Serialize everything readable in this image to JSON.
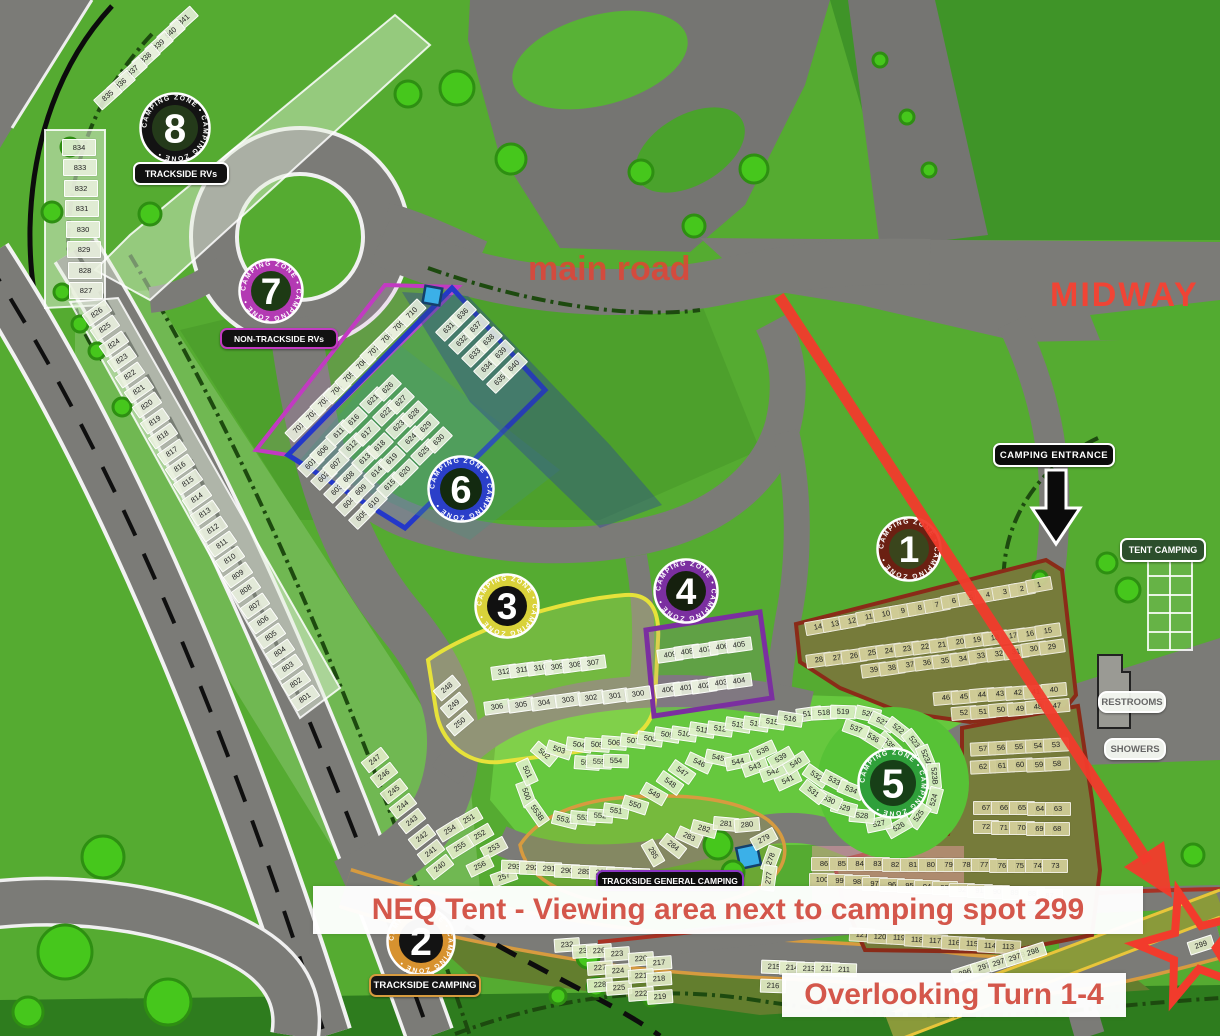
{
  "annotations": {
    "main_road": "main road",
    "midway": "MIDWAY",
    "banner_top": "NEQ Tent - Viewing area next to camping spot 299",
    "banner_bottom": "Overlooking Turn 1-4"
  },
  "labels": {
    "trackside_rvs": "TRACKSIDE RVs",
    "non_trackside_rvs": "NON-TRACKSIDE RVs",
    "camping_entrance": "CAMPING ENTRANCE",
    "tent_camping": "TENT CAMPING",
    "restrooms": "RESTROOMS",
    "showers": "SHOWERS",
    "trackside_general_camping": "TRACKSIDE GENERAL CAMPING",
    "trackside_camping": "TRACKSIDE CAMPING"
  },
  "colors": {
    "annotation_red": "#e8493c",
    "arrow_red": "#f23b2c",
    "road_gray": "#7b7b77",
    "grass_green": "#55ab31"
  },
  "ring_text": "CAMPING ZONE • CAMPING ZONE •",
  "badges": [
    {
      "n": "8",
      "x": 175,
      "y": 128,
      "d": 72,
      "ring": "#131313",
      "center": "#243a1a"
    },
    {
      "n": "7",
      "x": 271,
      "y": 291,
      "d": 66,
      "ring": "#b33ab3",
      "center": "#1d3a14"
    },
    {
      "n": "6",
      "x": 461,
      "y": 489,
      "d": 68,
      "ring": "#2b3fc9",
      "center": "#132a10"
    },
    {
      "n": "3",
      "x": 507,
      "y": 606,
      "d": 66,
      "ring": "#d9d23a",
      "center": "#111111"
    },
    {
      "n": "4",
      "x": 686,
      "y": 591,
      "d": 66,
      "ring": "#7b2fa0",
      "center": "#15200e"
    },
    {
      "n": "1",
      "x": 909,
      "y": 549,
      "d": 66,
      "ring": "#6b2012",
      "center": "#3a451c"
    },
    {
      "n": "5",
      "x": 893,
      "y": 783,
      "d": 72,
      "ring": "#2fa03a",
      "center": "#173f17"
    },
    {
      "n": "2",
      "x": 421,
      "y": 941,
      "d": 70,
      "ring": "#d7922f",
      "center": "#131313"
    }
  ],
  "clusters": [
    {
      "name": "zone8-strip",
      "style": "pale",
      "rot": -42,
      "cw": 26,
      "row": {
        "x": 183,
        "y": 19,
        "dx": -12.7,
        "dy": 12.7,
        "labels": [
          "841",
          "840",
          "839",
          "838",
          "837",
          "836",
          "835"
        ]
      }
    },
    {
      "name": "zone8-col",
      "style": "pale",
      "rot": 0,
      "cw": 32,
      "ch": 15,
      "row": {
        "x": 78,
        "y": 146,
        "dx": 1,
        "dy": 20.5,
        "labels": [
          "834",
          "833",
          "832",
          "831",
          "830",
          "829",
          "828",
          "827"
        ]
      }
    },
    {
      "name": "zone8-diag",
      "style": "pale",
      "rot": -35,
      "cw": 26,
      "row": {
        "x": 96,
        "y": 312,
        "dx": 8.3,
        "dy": 15.4,
        "labels": [
          "826",
          "825",
          "824",
          "823",
          "822",
          "821",
          "820",
          "819",
          "818",
          "817",
          "816",
          "815",
          "814",
          "813",
          "812",
          "811",
          "810",
          "809",
          "808",
          "807",
          "806",
          "805",
          "804",
          "803",
          "802",
          "801"
        ]
      }
    },
    {
      "name": "zone7-row",
      "style": "pale",
      "rot": -45,
      "cw": 26,
      "row": {
        "x": 298,
        "y": 427,
        "dx": 12.5,
        "dy": -12.8,
        "labels": [
          "701",
          "702",
          "703",
          "704",
          "705",
          "706",
          "707",
          "708",
          "709",
          "710"
        ]
      }
    },
    {
      "name": "zone6-grid",
      "style": "pale",
      "rot": -45,
      "grid": {
        "start": 601,
        "perCol": 5,
        "rowStep": [
          12.8,
          13
        ],
        "cols": [
          [
            310,
            463
          ],
          [
            322,
            450
          ],
          [
            338,
            432
          ],
          [
            353,
            419
          ],
          [
            372,
            399
          ],
          [
            387,
            387
          ],
          [
            448,
            327
          ],
          [
            462,
            313
          ]
        ]
      }
    },
    {
      "name": "zone3-r1",
      "style": "pale",
      "rot": -8,
      "row": {
        "x": 503,
        "y": 671,
        "dx": 17.8,
        "dy": -1.8,
        "labels": [
          "312",
          "311",
          "310",
          "309",
          "308",
          "307"
        ]
      }
    },
    {
      "name": "zone3-r2",
      "style": "pale",
      "rot": -8,
      "row": {
        "x": 496,
        "y": 706,
        "dx": 23.5,
        "dy": -2.2,
        "labels": [
          "306",
          "305",
          "304",
          "303",
          "302",
          "301",
          "300"
        ]
      }
    },
    {
      "name": "zone3-side",
      "style": "pale",
      "cells": [
        [
          "248",
          446,
          687,
          -40
        ],
        [
          "249",
          453,
          704,
          -40
        ],
        [
          "250",
          459,
          722,
          -40
        ]
      ]
    },
    {
      "name": "zone4-r1",
      "style": "pale",
      "rot": -8,
      "row": {
        "x": 669,
        "y": 654,
        "dx": 17.3,
        "dy": -2.6,
        "labels": [
          "409",
          "408",
          "407",
          "406",
          "405"
        ]
      }
    },
    {
      "name": "zone4-r2",
      "style": "pale",
      "rot": -8,
      "row": {
        "x": 667,
        "y": 689,
        "dx": 17.8,
        "dy": -2.2,
        "labels": [
          "400",
          "401",
          "402",
          "403",
          "404"
        ]
      }
    },
    {
      "name": "zone1-r1",
      "style": "olive",
      "rot": -10,
      "row": {
        "x": 817,
        "y": 626,
        "dx": 17.0,
        "dy": -3.2,
        "labels": [
          "14",
          "13",
          "12",
          "11",
          "10",
          "9",
          "8",
          "7",
          "6",
          "5",
          "4",
          "3",
          "2",
          "1"
        ]
      }
    },
    {
      "name": "zone1-r2",
      "style": "olive",
      "rot": -8,
      "row": {
        "x": 818,
        "y": 659,
        "dx": 17.6,
        "dy": -2.2,
        "labels": [
          "28",
          "27",
          "26",
          "25",
          "24",
          "23",
          "22",
          "21",
          "20",
          "19",
          "18",
          "17",
          "16",
          "15"
        ]
      }
    },
    {
      "name": "zone1-r3",
      "style": "olive",
      "rot": -8,
      "row": {
        "x": 873,
        "y": 669,
        "dx": 17.8,
        "dy": -2.3,
        "labels": [
          "39",
          "38",
          "37",
          "36",
          "35",
          "34",
          "33",
          "32",
          "31",
          "30",
          "29"
        ]
      }
    },
    {
      "name": "zone1-r4",
      "style": "olive",
      "rot": -5,
      "row": {
        "x": 945,
        "y": 697,
        "dx": 18,
        "dy": -1.3,
        "labels": [
          "46",
          "45",
          "44",
          "43",
          "42",
          "41",
          "40"
        ]
      }
    },
    {
      "name": "zone1-r5",
      "style": "olive",
      "rot": -5,
      "row": {
        "x": 963,
        "y": 712,
        "dx": 18.5,
        "dy": -1.5,
        "labels": [
          "52",
          "51",
          "50",
          "49",
          "48",
          "47"
        ]
      }
    },
    {
      "name": "zone1-r6",
      "style": "olive",
      "rot": -3,
      "row": {
        "x": 982,
        "y": 748,
        "dx": 18.2,
        "dy": -1,
        "labels": [
          "57",
          "56",
          "55",
          "54",
          "53"
        ]
      }
    },
    {
      "name": "zone1-r7",
      "style": "olive",
      "rot": -3,
      "row": {
        "x": 982,
        "y": 766,
        "dx": 18.5,
        "dy": -0.8,
        "labels": [
          "62",
          "61",
          "60",
          "59",
          "58"
        ]
      }
    },
    {
      "name": "zone1-r8",
      "style": "olive",
      "rot": 0,
      "row": {
        "x": 985,
        "y": 807,
        "dx": 18,
        "dy": 0.2,
        "labels": [
          "67",
          "66",
          "65",
          "64",
          "63"
        ]
      }
    },
    {
      "name": "zone1-r9",
      "style": "olive",
      "rot": 0,
      "row": {
        "x": 985,
        "y": 826,
        "dx": 17.8,
        "dy": 0.5,
        "labels": [
          "72",
          "71",
          "70",
          "69",
          "68"
        ]
      }
    },
    {
      "name": "zone1-r10",
      "style": "olive",
      "rot": 0,
      "row": {
        "x": 823,
        "y": 863,
        "dx": 17.8,
        "dy": 0.15,
        "labels": [
          "86",
          "85",
          "84",
          "83",
          "82",
          "81",
          "80",
          "79",
          "78",
          "77",
          "76",
          "75",
          "74",
          "73"
        ]
      }
    },
    {
      "name": "zone1-r11",
      "style": "olive",
      "rot": 0,
      "row": {
        "x": 821,
        "y": 879,
        "dx": 17.5,
        "dy": 1.2,
        "labels": [
          "100",
          "99",
          "98",
          "97",
          "96",
          "95",
          "94",
          "93",
          "92",
          "91",
          "90",
          "89",
          "88",
          "87"
        ]
      }
    },
    {
      "name": "zone1-r12",
      "style": "olive",
      "rot": 3,
      "row": {
        "x": 861,
        "y": 934,
        "dx": 18.3,
        "dy": 1.5,
        "labels": [
          "121",
          "120",
          "119",
          "118",
          "117",
          "116",
          "115",
          "114",
          "113"
        ]
      }
    },
    {
      "name": "row-215",
      "style": "pale2",
      "rot": 2,
      "row": {
        "x": 773,
        "y": 966,
        "dx": 17.5,
        "dy": 0.8,
        "labels": [
          "215",
          "214",
          "213",
          "212",
          "211"
        ]
      }
    },
    {
      "name": "cell-216",
      "style": "pale2",
      "cells": [
        [
          "216",
          772,
          985,
          2
        ]
      ]
    },
    {
      "name": "zone5-ring",
      "style": "bright",
      "cells": [
        [
          "517",
          808,
          713,
          -8
        ],
        [
          "518",
          823,
          712,
          -3
        ],
        [
          "519",
          842,
          711,
          2
        ],
        [
          "520",
          867,
          713,
          12
        ],
        [
          "521",
          881,
          721,
          25
        ],
        [
          "522",
          897,
          728,
          38
        ],
        [
          "523",
          913,
          741,
          52
        ],
        [
          "523A",
          925,
          757,
          68
        ],
        [
          "523B",
          933,
          775,
          85
        ],
        [
          "524",
          933,
          799,
          -75
        ],
        [
          "525",
          918,
          815,
          -55
        ],
        [
          "526",
          898,
          826,
          -30
        ],
        [
          "527",
          878,
          823,
          -12
        ],
        [
          "528",
          861,
          815,
          5
        ],
        [
          "529",
          843,
          807,
          15
        ],
        [
          "530",
          828,
          799,
          25
        ],
        [
          "531",
          812,
          791,
          38
        ],
        [
          "532",
          815,
          775,
          35
        ],
        [
          "533",
          833,
          780,
          28
        ],
        [
          "534",
          850,
          789,
          22
        ],
        [
          "535",
          888,
          743,
          45
        ],
        [
          "536",
          872,
          737,
          32
        ],
        [
          "537",
          855,
          728,
          20
        ]
      ]
    },
    {
      "name": "serpentine-500s",
      "style": "bright",
      "cells": [
        [
          "500",
          525,
          793,
          70
        ],
        [
          "501",
          526,
          771,
          65
        ],
        [
          "502",
          543,
          753,
          40
        ],
        [
          "503",
          558,
          749,
          18
        ],
        [
          "504",
          578,
          744,
          8
        ],
        [
          "505",
          596,
          744,
          4
        ],
        [
          "506",
          613,
          742,
          4
        ],
        [
          "507",
          632,
          740,
          7
        ],
        [
          "508",
          649,
          738,
          8
        ],
        [
          "509",
          666,
          734,
          9
        ],
        [
          "510",
          683,
          733,
          8
        ],
        [
          "511",
          701,
          729,
          9
        ],
        [
          "512",
          719,
          728,
          8
        ],
        [
          "513",
          737,
          724,
          9
        ],
        [
          "514",
          755,
          723,
          8
        ],
        [
          "515",
          771,
          721,
          8
        ],
        [
          "516",
          789,
          718,
          9
        ],
        [
          "556",
          586,
          762,
          4
        ],
        [
          "555",
          598,
          761,
          3
        ],
        [
          "554",
          615,
          760,
          2
        ],
        [
          "553B",
          536,
          812,
          55
        ],
        [
          "553A",
          564,
          819,
          14
        ],
        [
          "553",
          582,
          817,
          5
        ],
        [
          "552",
          599,
          815,
          3
        ],
        [
          "551",
          615,
          810,
          8
        ],
        [
          "550",
          634,
          804,
          18
        ],
        [
          "549",
          653,
          793,
          30
        ],
        [
          "548",
          669,
          782,
          35
        ],
        [
          "547",
          681,
          771,
          35
        ],
        [
          "546",
          698,
          762,
          25
        ],
        [
          "545",
          717,
          757,
          12
        ],
        [
          "544",
          737,
          761,
          -12
        ],
        [
          "543",
          754,
          766,
          -20
        ],
        [
          "542",
          772,
          771,
          -20
        ],
        [
          "541",
          787,
          779,
          -25
        ],
        [
          "540",
          795,
          762,
          -33
        ],
        [
          "539",
          780,
          757,
          -30
        ],
        [
          "538",
          762,
          750,
          -25
        ]
      ]
    },
    {
      "name": "strip-240s",
      "style": "pale2",
      "rot": -38,
      "row": {
        "x": 374,
        "y": 759,
        "dx": 9.3,
        "dy": 15.3,
        "labels": [
          "247",
          "246",
          "245",
          "244",
          "243",
          "242",
          "241",
          "240"
        ]
      }
    },
    {
      "name": "scatter-250s",
      "style": "pale2",
      "cells": [
        [
          "251",
          468,
          818,
          -30
        ],
        [
          "254",
          449,
          829,
          -32
        ],
        [
          "252",
          479,
          834,
          -30
        ],
        [
          "255",
          459,
          846,
          -32
        ],
        [
          "253",
          493,
          847,
          -28
        ],
        [
          "256",
          479,
          865,
          -26
        ],
        [
          "257",
          503,
          876,
          -20
        ]
      ]
    },
    {
      "name": "loop-280s",
      "style": "pale2",
      "cells": [
        [
          "285",
          652,
          852,
          60
        ],
        [
          "284",
          672,
          845,
          38
        ],
        [
          "283",
          688,
          836,
          25
        ],
        [
          "282",
          703,
          828,
          15
        ],
        [
          "281",
          725,
          823,
          5
        ],
        [
          "280",
          746,
          824,
          -5
        ],
        [
          "279",
          763,
          838,
          -28
        ],
        [
          "278",
          770,
          858,
          -70
        ],
        [
          "277",
          768,
          877,
          -82
        ]
      ]
    },
    {
      "name": "row-286-293",
      "style": "pale2",
      "rot": 2,
      "row": {
        "x": 513,
        "y": 866,
        "dx": 17.5,
        "dy": 1.2,
        "labels": [
          "293",
          "292",
          "291",
          "290",
          "289",
          "288",
          "287",
          "286"
        ]
      }
    },
    {
      "name": "blocks-220s",
      "style": "pale2",
      "cells": [
        [
          "232",
          566,
          944,
          -4
        ],
        [
          "230",
          584,
          950,
          -4
        ],
        [
          "226",
          598,
          950,
          -4
        ],
        [
          "223",
          616,
          953,
          -4
        ],
        [
          "227",
          599,
          967,
          -4
        ],
        [
          "224",
          617,
          970,
          -4
        ],
        [
          "228",
          599,
          984,
          -4
        ],
        [
          "225",
          618,
          987,
          -4
        ],
        [
          "220",
          640,
          958,
          -4
        ],
        [
          "217",
          658,
          962,
          -4
        ],
        [
          "221",
          640,
          975,
          -4
        ],
        [
          "218",
          658,
          978,
          -4
        ],
        [
          "222",
          640,
          993,
          -4
        ],
        [
          "219",
          659,
          996,
          -4
        ]
      ]
    },
    {
      "name": "diag-290s",
      "style": "pale2",
      "cells": [
        [
          "296",
          964,
          972,
          -18
        ],
        [
          "297",
          983,
          966,
          -18
        ],
        [
          "297A",
          1000,
          961,
          -18
        ],
        [
          "297B",
          1016,
          956,
          -18
        ],
        [
          "298",
          1032,
          951,
          -18
        ],
        [
          "299",
          1200,
          944,
          -18
        ]
      ]
    }
  ]
}
